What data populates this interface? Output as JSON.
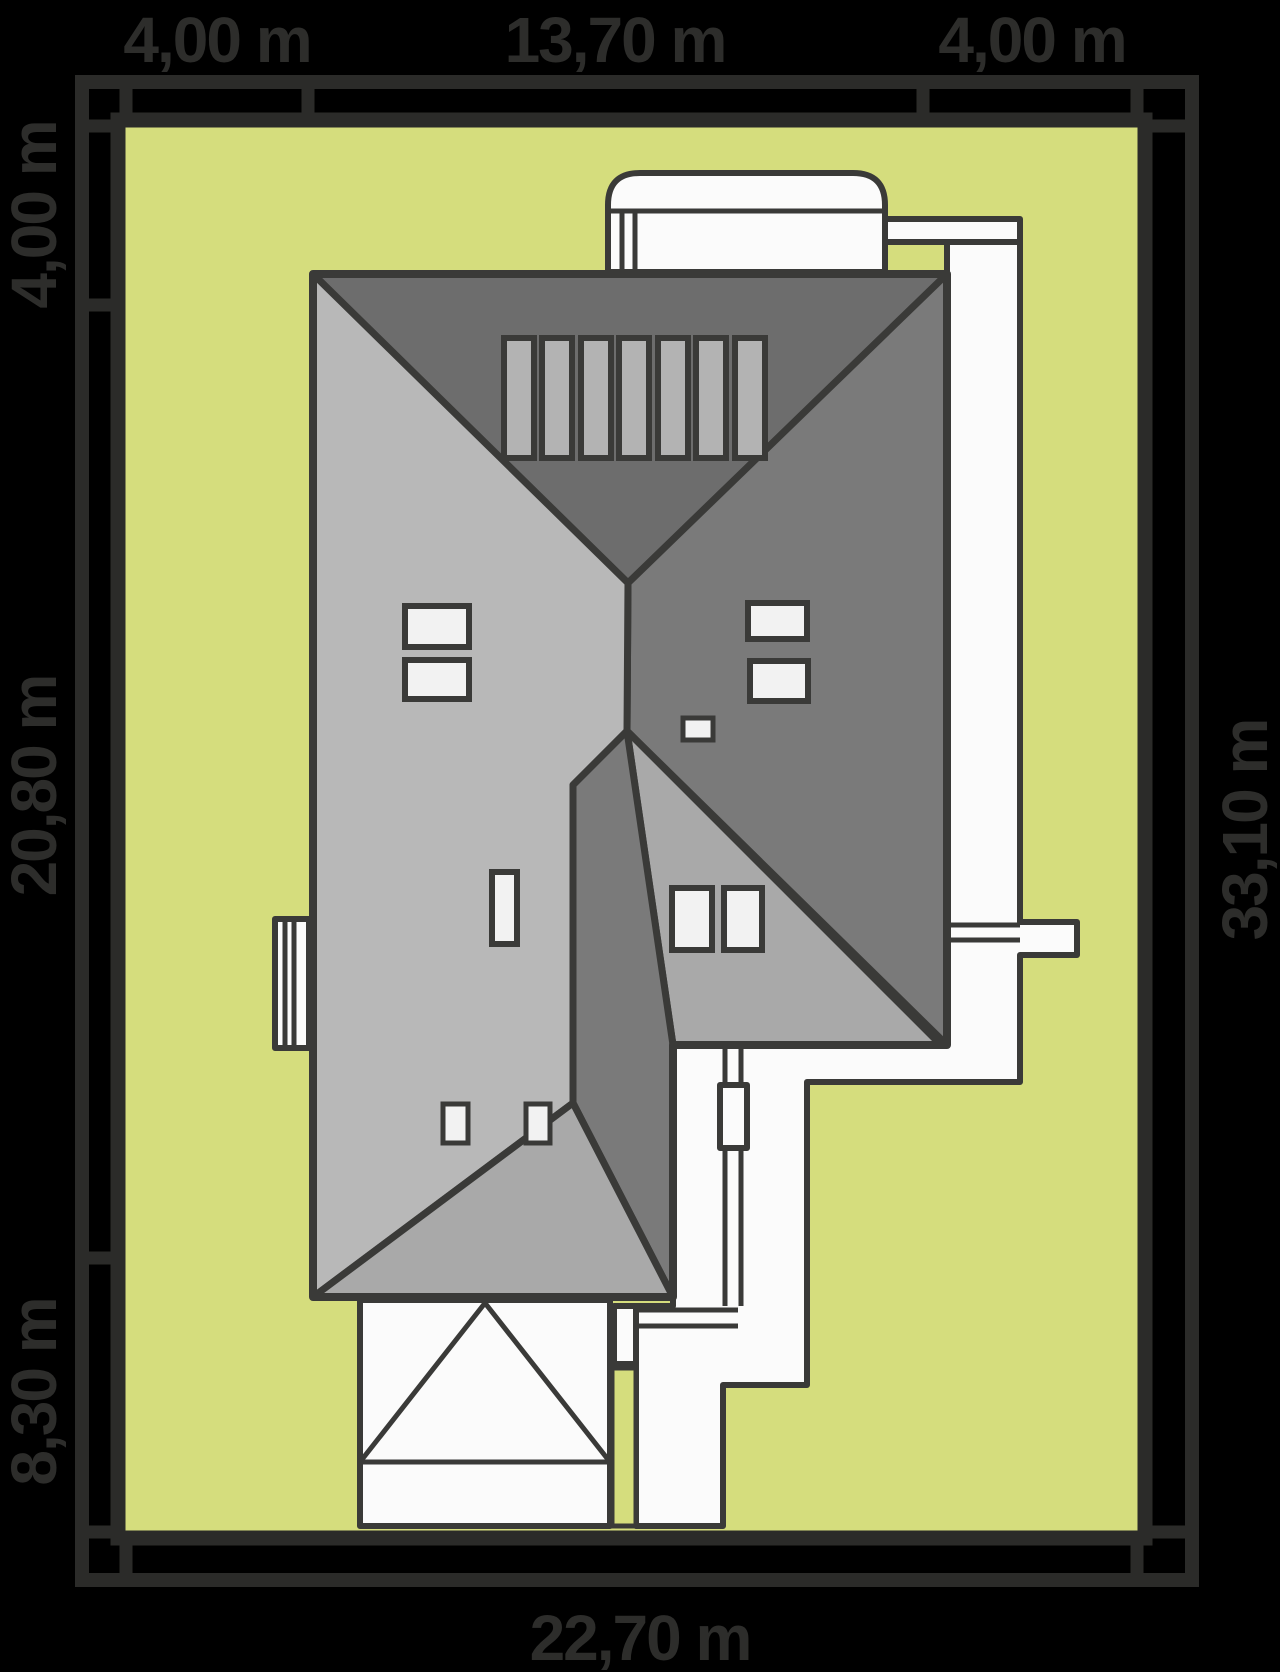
{
  "title": "House roof site plan",
  "plot": {
    "dimensions": {
      "top": [
        "4,00 m",
        "13,70 m",
        "4,00 m"
      ],
      "left": [
        "4,00 m",
        "20,80 m",
        "8,30 m"
      ],
      "right": [
        "33,10 m"
      ],
      "bottom": [
        "22,70 m"
      ]
    }
  },
  "colors": {
    "background": "#000000",
    "frame": "#2b2b29",
    "grass": "#d5dd7d",
    "outline": "#3a3a38",
    "roof_north": "#6d6d6d",
    "roof_east": "#7a7a7a",
    "roof_west": "#b8b8b8",
    "roof_wing": "#a9a9a9",
    "roof_south": "#a9a9a9",
    "paving": "#fbfbfb",
    "window": "#f2f2f2",
    "panel": "#b3b3b3",
    "label": "#2d2d2b"
  }
}
